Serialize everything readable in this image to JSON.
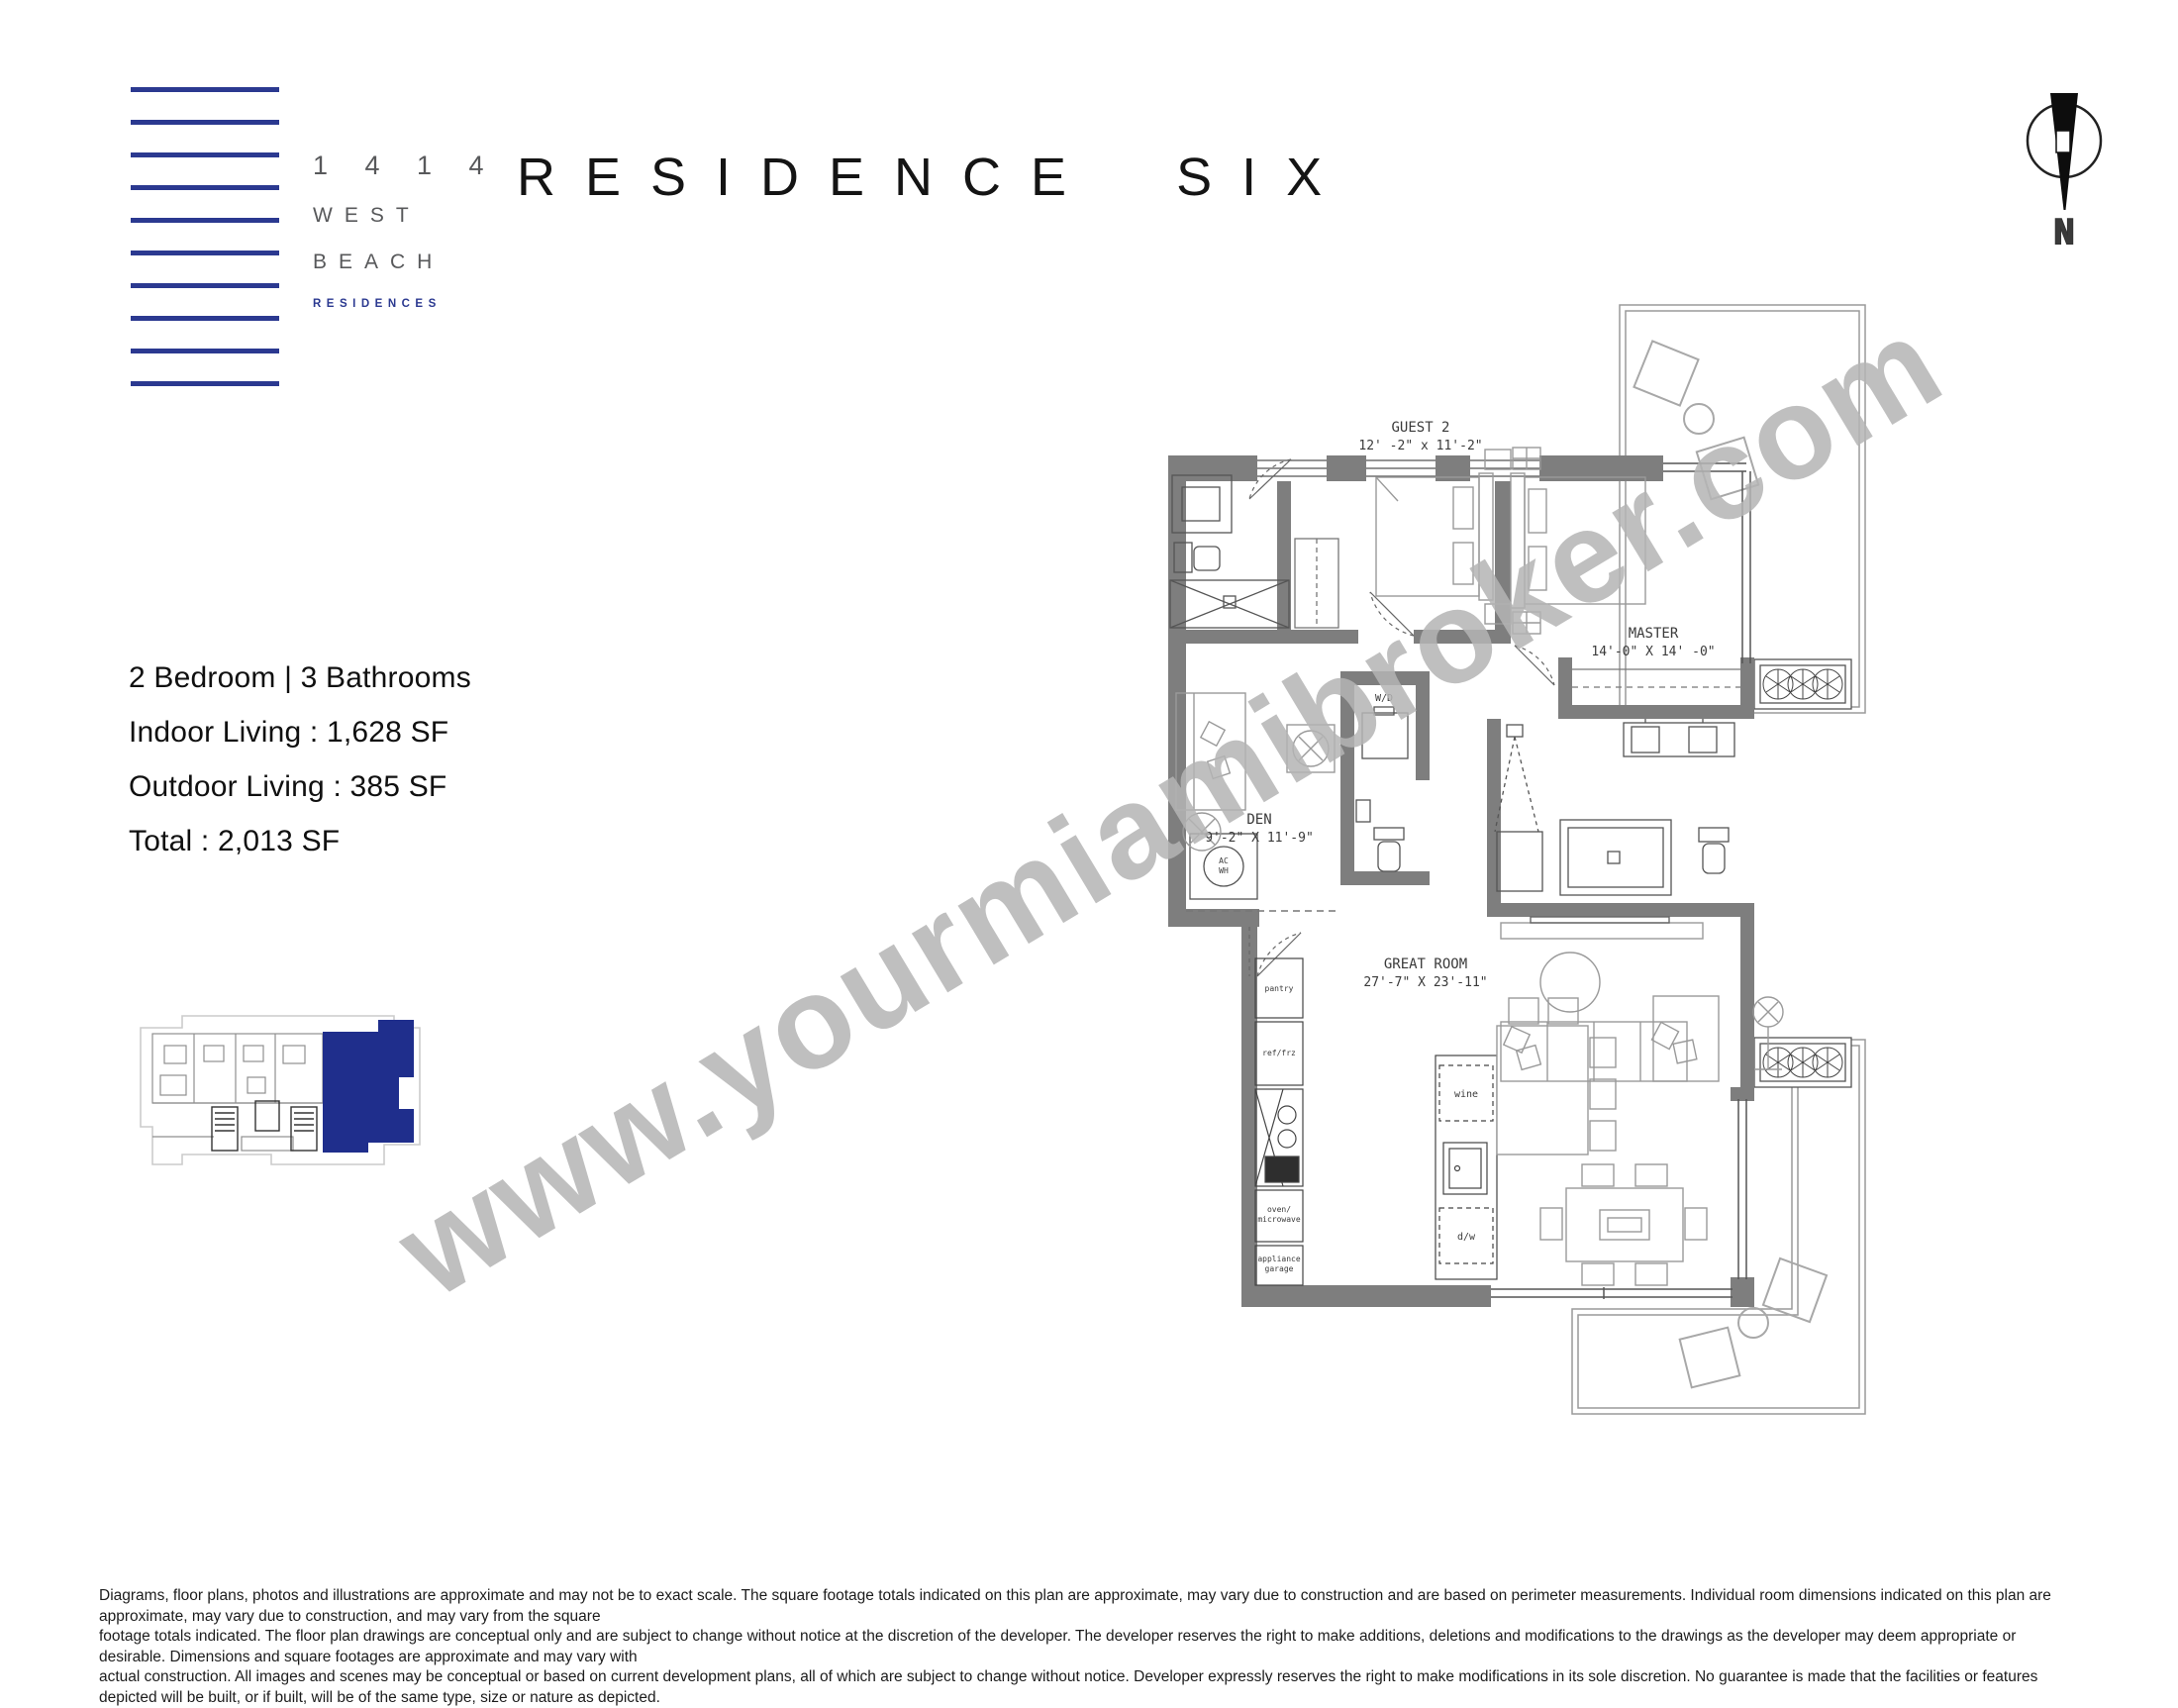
{
  "logo": {
    "address": "1 4 1 4",
    "name1": "WEST",
    "name2": "BEACH",
    "name3": "RESIDENCES",
    "accent_blue": "#2b3990"
  },
  "title": "RESIDENCE SIX",
  "compass": {
    "label": "N"
  },
  "specs": {
    "config": "2 Bedroom | 3 Bathrooms",
    "indoor": "Indoor Living :  1,628 SF",
    "outdoor": "Outdoor Living :  385 SF",
    "total": "Total :  2,013 SF"
  },
  "keyplan": {
    "highlight_color": "#1f2e8c"
  },
  "floorplan": {
    "wall_color": "#7e7e7e",
    "rooms": {
      "guest2": {
        "name": "GUEST 2",
        "dims": "12' -2\" x 11'-2\""
      },
      "master": {
        "name": "MASTER",
        "dims": "14'-0\" X 14' -0\""
      },
      "den": {
        "name": "DEN",
        "dims": "9'-2\" X 11'-9\""
      },
      "great": {
        "name": "GREAT ROOM",
        "dims": "27'-7\" X 23'-11\""
      }
    },
    "labels": {
      "wd": "W/D",
      "ac": "AC",
      "wh": "WH",
      "pantry": "pantry",
      "reffrz": "ref/frz",
      "oven1": "oven/",
      "oven2": "microwave",
      "app1": "appliance",
      "app2": "garage",
      "wine": "wine",
      "dw": "d/w"
    }
  },
  "watermark": "www.yourmiamibroker.com",
  "disclaimer": {
    "line1": "Diagrams, floor plans, photos and illustrations are approximate and may not be to exact scale. The square footage totals indicated on this plan are approximate, may vary due to construction and are based on perimeter measurements. Individual room dimensions indicated on this plan are approximate, may vary due to construction, and may vary from the square",
    "line2": "footage totals indicated. The floor plan drawings are conceptual only and are subject to change without notice at the discretion of the developer. The developer reserves the right to make additions, deletions and modifications to the drawings as the developer may deem appropriate or desirable. Dimensions and square footages are approximate and may vary with",
    "line3": "actual construction. All images and scenes may be conceptual or based on current development plans, all of which are subject to change without notice. Developer expressly reserves the right to make modifications in its sole discretion. No guarantee is made that the facilities or features depicted will be built, or if built, will be of the same type, size or nature as depicted."
  }
}
